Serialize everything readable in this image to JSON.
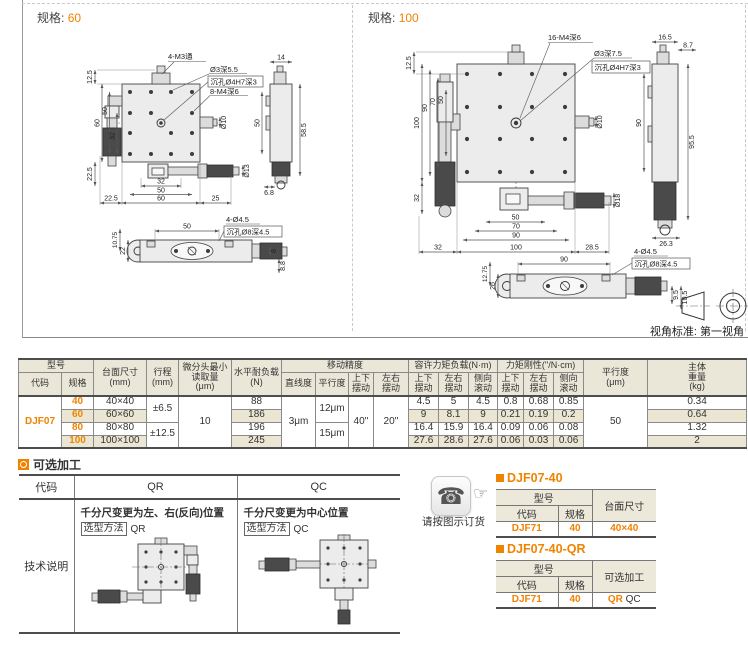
{
  "colors": {
    "accent": "#f08300",
    "header_bg": "#ebe7d8",
    "stripe_bg": "#eae6d3"
  },
  "dwg60": {
    "spec_label": "规格:",
    "spec_value": "60",
    "callouts": [
      "4-M3通",
      "Ø3深5.5",
      "沉孔Ø4H7深3",
      "8-M4深6",
      "4-Ø4.5",
      "沉孔Ø8深4.5"
    ],
    "dims": [
      "12.5",
      "60",
      "50",
      "32",
      "22.5",
      "32",
      "50",
      "22.5",
      "60",
      "25",
      "Ø10",
      "Ø13",
      "14",
      "50",
      "58.5",
      "6.8",
      "10.75",
      "22",
      "50",
      "8",
      "8.8"
    ]
  },
  "dwg100": {
    "spec_label": "规格:",
    "spec_value": "100",
    "callouts": [
      "16-M4深6",
      "Ø3深7.5",
      "沉孔Ø4H7深3",
      "4-Ø4.5",
      "沉孔Ø8深4.5"
    ],
    "dims": [
      "12.5",
      "100",
      "90",
      "70",
      "50",
      "32",
      "50",
      "70",
      "90",
      "32",
      "100",
      "28.5",
      "Ø10",
      "Ø18",
      "16.5",
      "8.7",
      "90",
      "95.5",
      "26.3",
      "12.75",
      "26",
      "90",
      "9.5",
      "10.5"
    ],
    "view_note": "视角标准: 第一视角"
  },
  "spec_table": {
    "headers": {
      "model": "型号",
      "code": "代码",
      "size": "规格",
      "table_size": "台面尺寸\n(mm)",
      "stroke": "行程\n(mm)",
      "min_read": "微分头最小\n读取量\n(μm)",
      "h_load": "水平耐负载\n(N)",
      "accuracy": "移动精度",
      "straight": "直线度",
      "parallel": "平行度",
      "ud": "上下\n摆动",
      "lr": "左右\n摆动",
      "roll": "侧向\n滚动",
      "moment": "容许力矩负载(N·m)",
      "stiff": "力矩刚性(''/N·cm)",
      "parallel2": "平行度\n(μm)",
      "weight": "主体\n重量\n(kg)"
    },
    "code_value": "DJF07",
    "merged": {
      "stroke12": "±6.5",
      "stroke34": "±12.5",
      "min_read": "10",
      "straight": "3μm",
      "par12": "12μm",
      "par34": "15μm",
      "pitch": "40''",
      "yaw": "20''",
      "parallel_um": "50"
    },
    "rows": [
      {
        "size": "40",
        "table_size": "40×40",
        "load": "88",
        "m_ud": "4.5",
        "m_lr": "5",
        "m_roll": "4.5",
        "s_ud": "0.8",
        "s_lr": "0.68",
        "s_roll": "0.85",
        "weight": "0.34"
      },
      {
        "size": "60",
        "table_size": "60×60",
        "load": "186",
        "m_ud": "9",
        "m_lr": "8.1",
        "m_roll": "9",
        "s_ud": "0.21",
        "s_lr": "0.19",
        "s_roll": "0.2",
        "weight": "0.64"
      },
      {
        "size": "80",
        "table_size": "80×80",
        "load": "196",
        "m_ud": "16.4",
        "m_lr": "15.9",
        "m_roll": "16.4",
        "s_ud": "0.09",
        "s_lr": "0.06",
        "s_roll": "0.08",
        "weight": "1.32"
      },
      {
        "size": "100",
        "table_size": "100×100",
        "load": "245",
        "m_ud": "27.6",
        "m_lr": "28.6",
        "m_roll": "27.6",
        "s_ud": "0.06",
        "s_lr": "0.03",
        "s_roll": "0.06",
        "weight": "2"
      }
    ]
  },
  "optional": {
    "title": "可选加工",
    "h_code": "代码",
    "h_qr": "QR",
    "h_qc": "QC",
    "row_label": "技术说明",
    "qr_desc": "千分尺变更为左、右(反向)位置",
    "qr_method_label": "选型方法",
    "qr_method_value": "QR",
    "qc_desc": "千分尺变更为中心位置",
    "qc_method_label": "选型方法",
    "qc_method_value": "QC"
  },
  "ordering": {
    "phone_note": "请按图示订货",
    "example1": {
      "title": "DJF07-40",
      "h_model": "型号",
      "h_code": "代码",
      "h_size": "规格",
      "h_table": "台面尺寸",
      "code": "DJF71",
      "size": "40",
      "table": "40×40"
    },
    "example2": {
      "title": "DJF07-40-QR",
      "h_model": "型号",
      "h_code": "代码",
      "h_size": "规格",
      "h_opt": "可选加工",
      "code": "DJF71",
      "size": "40",
      "opt1": "QR",
      "opt2": "QC"
    }
  }
}
